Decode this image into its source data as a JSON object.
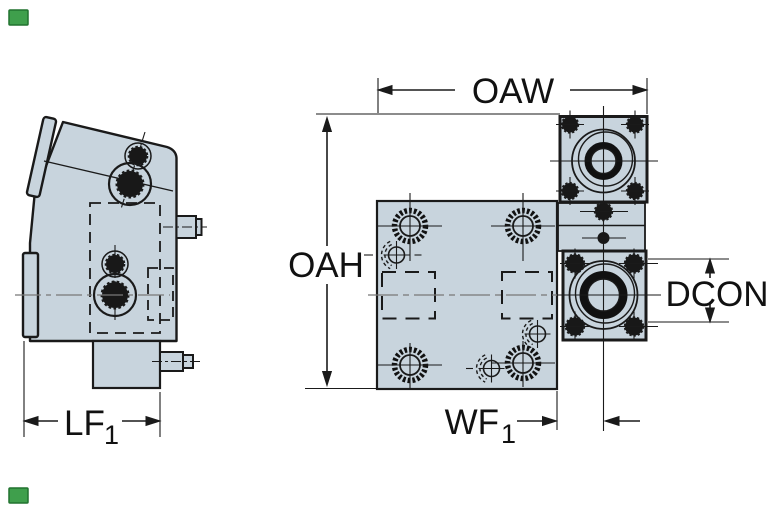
{
  "drawing": {
    "type": "technical-dimension-drawing",
    "views": 2,
    "dimension_labels": {
      "oaw": "OAW",
      "oah": "OAH",
      "dcon": "DCON",
      "wf_main": "WF",
      "wf_sub": "1",
      "lf_main": "LF",
      "lf_sub": "1"
    },
    "colors": {
      "part_fill": "#c8d4dd",
      "outline": "#1a1a1a",
      "dark_fill": "#181818",
      "centerline_gray": "#777777",
      "background": "#ffffff",
      "corner_marker_green": "#3f9f4c",
      "corner_marker_border": "#20722f"
    }
  }
}
